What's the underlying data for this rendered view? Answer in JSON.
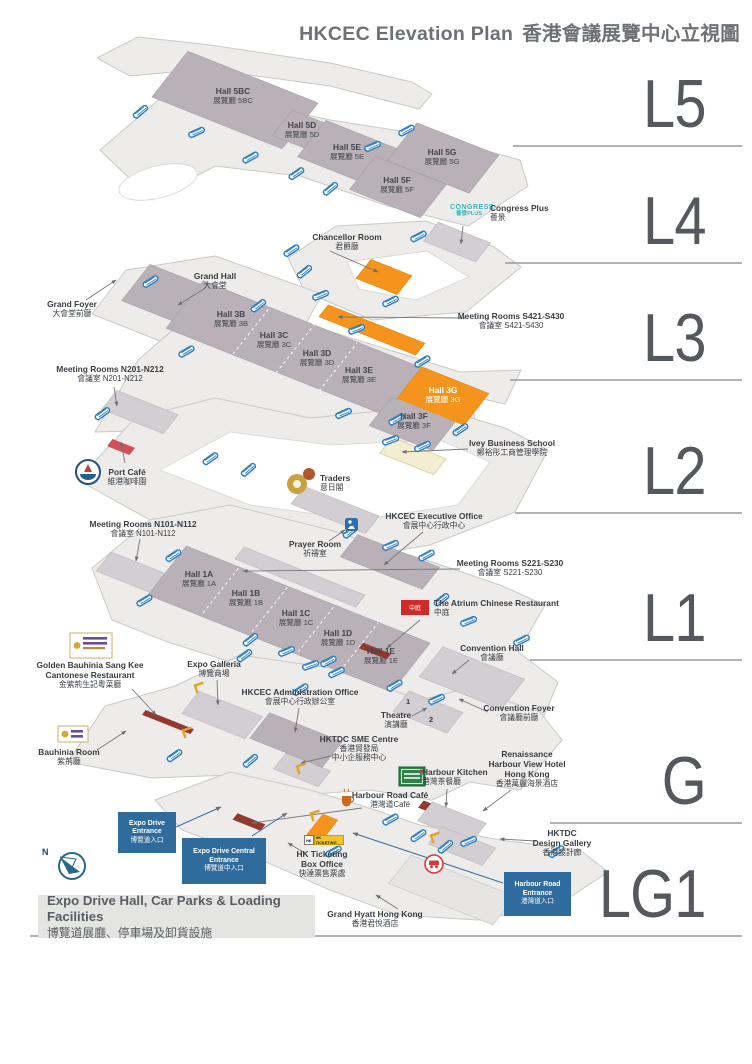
{
  "title": {
    "en": "HKCEC Elevation Plan",
    "zh": "香港會議展覽中心立視圖"
  },
  "levels": [
    {
      "id": "L5"
    },
    {
      "id": "L4"
    },
    {
      "id": "L3"
    },
    {
      "id": "L2"
    },
    {
      "id": "L1"
    },
    {
      "id": "G"
    },
    {
      "id": "LG1"
    }
  ],
  "colors": {
    "accent_orange": "#F5941D",
    "escalator_blue": "#2B7FC3",
    "entrance_box_blue": "#2F6B9D",
    "congress_teal": "#3EB3C3",
    "highlight_red": "#C23B3B"
  },
  "compass": {
    "north": "N"
  },
  "logos": {
    "congress_line1": "CONGRESS",
    "congress_line2": "薈景PLUS",
    "hk_ticketing": "HK TICKETING",
    "atrium": "中庭"
  },
  "labels": {
    "hall5bc": {
      "lines": [
        "Hall 5BC",
        "展覽廳 5BC"
      ]
    },
    "hall5d": {
      "lines": [
        "Hall 5D",
        "展覽廳 5D"
      ]
    },
    "hall5e": {
      "lines": [
        "Hall 5E",
        "展覽廳 5E"
      ]
    },
    "hall5g": {
      "lines": [
        "Hall 5G",
        "展覽廳 5G"
      ]
    },
    "hall5f": {
      "lines": [
        "Hall 5F",
        "展覽廳 5F"
      ]
    },
    "congress_plus": {
      "lines": [
        "Congress Plus",
        "薈景"
      ]
    },
    "chancellor": {
      "lines": [
        "Chancellor Room",
        "君爵廳"
      ]
    },
    "s421": {
      "lines": [
        "Meeting Rooms S421-S430",
        "會議室 S421-S430"
      ]
    },
    "grand_hall": {
      "lines": [
        "Grand Hall",
        "大會堂"
      ]
    },
    "grand_foyer": {
      "lines": [
        "Grand Foyer",
        "大會堂前廳"
      ]
    },
    "hall3b": {
      "lines": [
        "Hall 3B",
        "展覽廳 3B"
      ]
    },
    "hall3c": {
      "lines": [
        "Hall 3C",
        "展覽廳 3C"
      ]
    },
    "hall3d": {
      "lines": [
        "Hall 3D",
        "展覽廳 3D"
      ]
    },
    "hall3e": {
      "lines": [
        "Hall 3E",
        "展覽廳 3E"
      ]
    },
    "n201": {
      "lines": [
        "Meeting Rooms N201-N212",
        "會議室 N201-N212"
      ]
    },
    "hall3g": {
      "lines": [
        "Hall 3G",
        "展覽廳 3G"
      ]
    },
    "hall3f": {
      "lines": [
        "Hall 3F",
        "展覽廳 3F"
      ]
    },
    "ivey": {
      "lines": [
        "Ivey Business School",
        "鄭裕彤工商管理學院"
      ]
    },
    "port_cafe": {
      "lines": [
        "Port Café",
        "維港咖啡園"
      ]
    },
    "traders": {
      "lines": [
        "Traders",
        "意日閣"
      ]
    },
    "n101": {
      "lines": [
        "Meeting Rooms N101-N112",
        "會議室 N101-N112"
      ]
    },
    "prayer": {
      "lines": [
        "Prayer Room",
        "祈禱室"
      ]
    },
    "exec_office": {
      "lines": [
        "HKCEC Executive Office",
        "會展中心行政中心"
      ]
    },
    "s221": {
      "lines": [
        "Meeting Rooms S221-S230",
        "會議室 S221-S230"
      ]
    },
    "hall1a": {
      "lines": [
        "Hall 1A",
        "展覽廳 1A"
      ]
    },
    "hall1b": {
      "lines": [
        "Hall 1B",
        "展覽廳 1B"
      ]
    },
    "hall1c": {
      "lines": [
        "Hall 1C",
        "展覽廳 1C"
      ]
    },
    "hall1d": {
      "lines": [
        "Hall 1D",
        "展覽廳 1D"
      ]
    },
    "hall1e": {
      "lines": [
        "Hall 1E",
        "展覽廳 1E"
      ]
    },
    "atrium": {
      "lines": [
        "The Atrium Chinese Restaurant",
        "中庭"
      ]
    },
    "convention_hall": {
      "lines": [
        "Convention Hall",
        "會議廳"
      ]
    },
    "theatre": {
      "lines": [
        "Theatre",
        "演講廳"
      ]
    },
    "theatre_1": "1",
    "theatre_2": "2",
    "convention_foyer": {
      "lines": [
        "Convention Foyer",
        "會議廳前廳"
      ]
    },
    "golden_bauhinia": {
      "lines": [
        "Golden Bauhinia Sang Kee",
        "Cantonese Restaurant",
        "金紫荊生記粵菜廳"
      ]
    },
    "expo_galleria": {
      "lines": [
        "Expo Galleria",
        "博覽商場"
      ]
    },
    "admin_office": {
      "lines": [
        "HKCEC Administration Office",
        "會展中心行政辦公室"
      ]
    },
    "bauhinia_room": {
      "lines": [
        "Bauhinia Room",
        "紫荊廳"
      ]
    },
    "sme": {
      "lines": [
        "HKTDC SME Centre",
        "香港貿發局",
        "中小企服務中心"
      ]
    },
    "harbour_kitchen": {
      "lines": [
        "Harbour Kitchen",
        "港灣茶餐廳"
      ]
    },
    "renaissance": {
      "lines": [
        "Renaissance",
        "Harbour View Hotel",
        "Hong Kong",
        "香港萬麗海景酒店"
      ]
    },
    "hr_cafe": {
      "lines": [
        "Harbour Road Café",
        "港灣道Café"
      ]
    },
    "design_gallery": {
      "lines": [
        "HKTDC",
        "Design Gallery",
        "香港設計廊"
      ]
    },
    "hk_ticketing": {
      "lines": [
        "HK Ticketing",
        "Box Office",
        "快達票售票處"
      ]
    },
    "grand_hyatt": {
      "lines": [
        "Grand Hyatt Hong Kong",
        "香港君悅酒店"
      ]
    },
    "expo_drive_entrance": {
      "lines": [
        "Expo Drive Entrance",
        "博覽道入口"
      ]
    },
    "expo_drive_central": {
      "lines": [
        "Expo Drive Central Entrance",
        "博覽道中入口"
      ]
    },
    "harbour_road_entrance": {
      "lines": [
        "Harbour Road Entrance",
        "港灣道入口"
      ]
    },
    "footer": {
      "lines": [
        "Expo Drive Hall, Car Parks & Loading Facilities",
        "博覽道展廳、停車場及卸貨設施"
      ]
    }
  }
}
